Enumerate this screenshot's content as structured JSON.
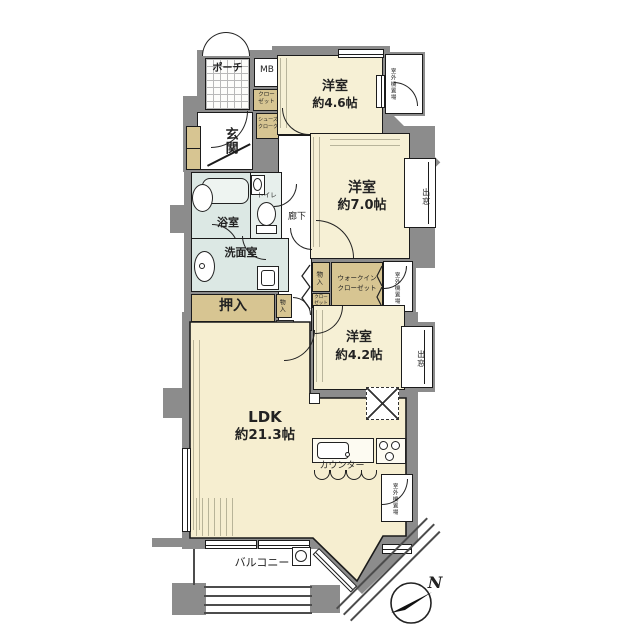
{
  "floor_plan": {
    "rooms": [
      {
        "name": "洋室",
        "size": "約4.6帖"
      },
      {
        "name": "洋室",
        "size": "約7.0帖"
      },
      {
        "name": "洋室",
        "size": "約4.2帖"
      },
      {
        "name": "LDK",
        "size": "約21.3帖"
      }
    ],
    "labels": {
      "porch": "ポーチ",
      "meter_box": "MB",
      "closet_l1": "クロー",
      "closet_l2": "ゼット",
      "shoe_closet_l1": "シューズ",
      "shoe_closet_l2": "クローク",
      "entrance": "玄関",
      "bathroom": "浴室",
      "toilet": "トイレ",
      "hallway": "廊下",
      "washroom": "洗面室",
      "oshiire": "押入",
      "storage": "物入",
      "wic_l1": "ウォークイン",
      "wic_l2": "クローゼット",
      "bay_window": "出窓",
      "outdoor_unit": "室外機置場",
      "counter": "カウンター",
      "balcony": "バルコニー",
      "north": "N"
    },
    "colors": {
      "wall": "#8c8c8c",
      "room_floor": "#f6f0d5",
      "ldk_floor": "#f6eed0",
      "wet_area": "#dce8e4",
      "storage": "#d7c592",
      "outline": "#1b1b1b"
    }
  }
}
